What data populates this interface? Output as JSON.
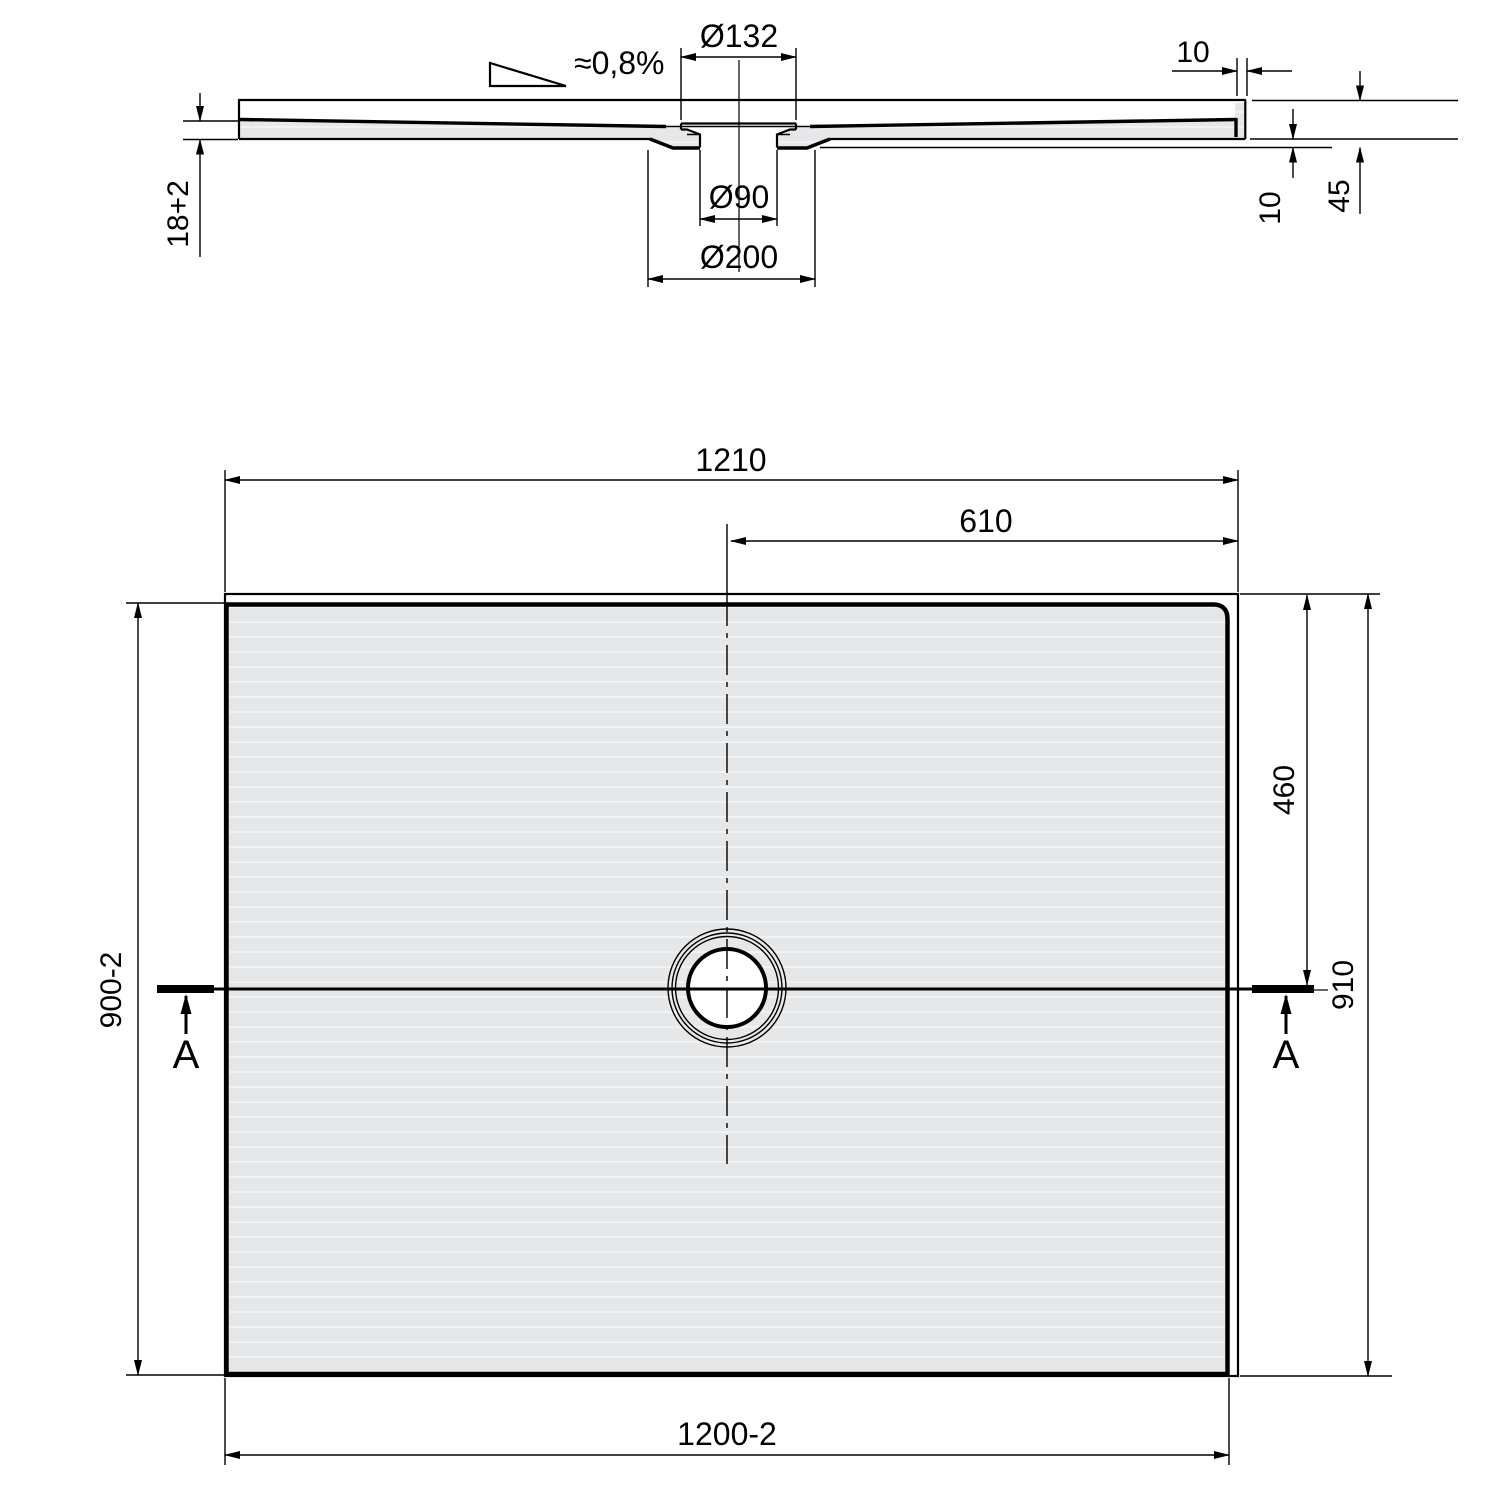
{
  "section": {
    "slope": "≈0,8%",
    "flange_dia": "Ø132",
    "drain_dia": "Ø90",
    "recess_dia": "Ø200",
    "panel_thickness": "18+2",
    "edge_width": "10",
    "drain_drop": "10",
    "edge_height": "45"
  },
  "plan": {
    "overall_width": "1210",
    "half_width": "610",
    "inner_height": "900-2",
    "drain_offset_top": "460",
    "overall_height": "910",
    "inner_width": "1200-2",
    "cut_label_left": "A",
    "cut_label_right": "A"
  },
  "colors": {
    "line": "#000000",
    "surface_fill": "#e6e7e9",
    "background": "#ffffff"
  }
}
